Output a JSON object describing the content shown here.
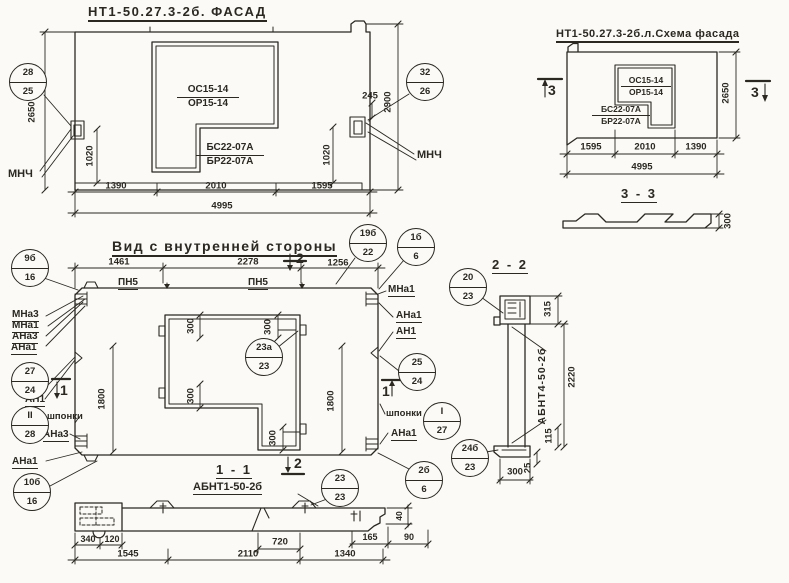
{
  "facade": {
    "title": "НТ1-50.27.3-2б. ФАСАД",
    "win_top_num": "ОС15-14",
    "win_top_den": "ОР15-14",
    "win_bot_num": "БС22-07А",
    "win_bot_den": "БР22-07А",
    "anchor_left": "МНЧ",
    "anchor_right": "МНЧ",
    "dim_h_left": "2650",
    "dim_h_right": "2900",
    "dim_anchor_left": "1020",
    "dim_anchor_right": "1020",
    "dim_offset": "245",
    "dim_w1": "1390",
    "dim_w2": "2010",
    "dim_w3": "1595",
    "dim_total": "4995"
  },
  "schema": {
    "title": "НТ1-50.27.3-2б.л.Схема фасада",
    "win_top_num": "ОС15-14",
    "win_top_den": "ОР15-14",
    "win_bot_num": "БС22-07А",
    "win_bot_den": "БР22-07А",
    "dim_w1": "1595",
    "dim_w2": "2010",
    "dim_w3": "1390",
    "dim_total": "4995",
    "dim_h": "2650",
    "mark_left": "3",
    "mark_right": "3"
  },
  "section33": {
    "title": "3 - 3",
    "dim_thickness": "300"
  },
  "inner": {
    "title": "Вид с внутренней стороны",
    "dim_t1": "1461",
    "dim_t2": "2278",
    "dim_t3": "1256",
    "loop_left": "ПН5",
    "loop_right": "ПН5",
    "mark_top": "2",
    "mark_bottom": "2",
    "mark_left": "1",
    "mark_right": "1",
    "dim_h_left": "1800",
    "dim_h_right": "1800",
    "dim_o1": "300",
    "dim_o2": "300",
    "dim_o3": "300",
    "dim_o4": "300",
    "left_labels": [
      "МНа3",
      "МНа1",
      "АНа3",
      "АНа1",
      "АН1",
      "шпонки",
      "АНа3",
      "АНа1"
    ],
    "right_labels": [
      "МНа1",
      "АНа1",
      "АН1",
      "шпонки",
      "АНа1"
    ]
  },
  "section22": {
    "title": "2 - 2",
    "part_label": "АБНТ4-50-2б",
    "dim_315": "315",
    "dim_2220": "2220",
    "dim_115": "115",
    "dim_25": "25",
    "dim_300": "300"
  },
  "section11": {
    "title": "1 - 1",
    "part_label": "АБНТ1-50-2б",
    "dim_340": "340",
    "dim_120": "120",
    "dim_720": "720",
    "dim_165": "165",
    "dim_90": "90",
    "dim_40": "40",
    "dim_b1": "1545",
    "dim_b2": "2110",
    "dim_b3": "1340"
  },
  "callouts": {
    "c28_25": {
      "top": "28",
      "bot": "25"
    },
    "c32_26": {
      "top": "32",
      "bot": "26"
    },
    "c9b_16": {
      "top": "9б",
      "bot": "16"
    },
    "c19b_22": {
      "top": "19б",
      "bot": "22"
    },
    "c1b_6": {
      "top": "1б",
      "bot": "6"
    },
    "c27_24": {
      "top": "27",
      "bot": "24"
    },
    "cII_28": {
      "top": "II",
      "bot": "28"
    },
    "c10b_16": {
      "top": "10б",
      "bot": "16"
    },
    "c25_24": {
      "top": "25",
      "bot": "24"
    },
    "cI_27": {
      "top": "I",
      "bot": "27"
    },
    "c23a_23": {
      "top": "23а",
      "bot": "23"
    },
    "c20_23": {
      "top": "20",
      "bot": "23"
    },
    "c24b_23": {
      "top": "24б",
      "bot": "23"
    },
    "c2b_6": {
      "top": "2б",
      "bot": "6"
    },
    "c23_23": {
      "top": "23",
      "bot": "23"
    }
  }
}
